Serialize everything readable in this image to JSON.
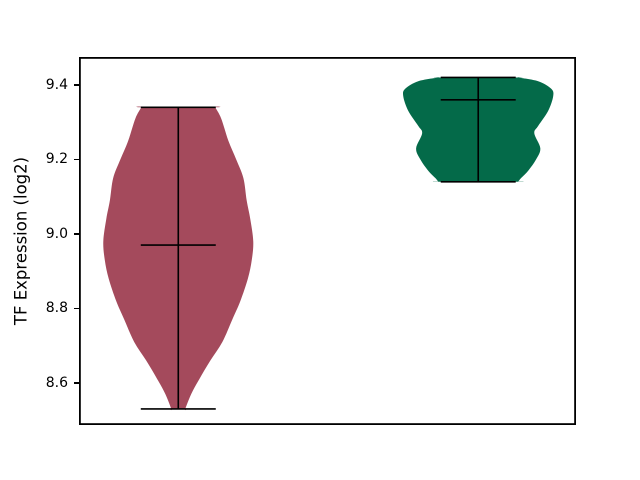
{
  "chart_data": {
    "type": "violin",
    "title": "",
    "xlabel": "",
    "ylabel": "TF Expression (log2)",
    "x_tick_labels": [],
    "y_ticks": [
      {
        "label": "9.4",
        "value": 9.4
      },
      {
        "label": "9.2",
        "value": 9.2
      },
      {
        "label": "9.0",
        "value": 9.0
      },
      {
        "label": "8.8",
        "value": 8.8
      },
      {
        "label": "8.6",
        "value": 8.6
      }
    ],
    "ylim": [
      8.487,
      9.475
    ],
    "xlim": [
      0.669,
      2.326
    ],
    "grid": false,
    "legend": null,
    "line_color": "#000000",
    "background_color": "#ffffff",
    "series": [
      {
        "name": "violin-1",
        "position": 1,
        "fill_color": "#a44a5c",
        "min": 8.53,
        "max": 9.34,
        "mean": 8.97,
        "cap_halfwidth": 0.125,
        "profile": [
          [
            9.34,
            0.123
          ],
          [
            9.31,
            0.143
          ],
          [
            9.25,
            0.167
          ],
          [
            9.2,
            0.193
          ],
          [
            9.15,
            0.217
          ],
          [
            9.09,
            0.228
          ],
          [
            9.04,
            0.24
          ],
          [
            8.98,
            0.25
          ],
          [
            8.93,
            0.245
          ],
          [
            8.88,
            0.232
          ],
          [
            8.82,
            0.207
          ],
          [
            8.77,
            0.18
          ],
          [
            8.71,
            0.147
          ],
          [
            8.66,
            0.107
          ],
          [
            8.61,
            0.07
          ],
          [
            8.57,
            0.043
          ],
          [
            8.53,
            0.023
          ]
        ]
      },
      {
        "name": "violin-2",
        "position": 2,
        "fill_color": "#046a49",
        "min": 9.14,
        "max": 9.42,
        "mean": 9.36,
        "cap_halfwidth": 0.125,
        "profile": [
          [
            9.42,
            0.133
          ],
          [
            9.41,
            0.2
          ],
          [
            9.39,
            0.243
          ],
          [
            9.37,
            0.25
          ],
          [
            9.33,
            0.233
          ],
          [
            9.29,
            0.2
          ],
          [
            9.27,
            0.187
          ],
          [
            9.23,
            0.207
          ],
          [
            9.2,
            0.193
          ],
          [
            9.17,
            0.167
          ],
          [
            9.15,
            0.143
          ],
          [
            9.14,
            0.133
          ]
        ]
      }
    ]
  }
}
